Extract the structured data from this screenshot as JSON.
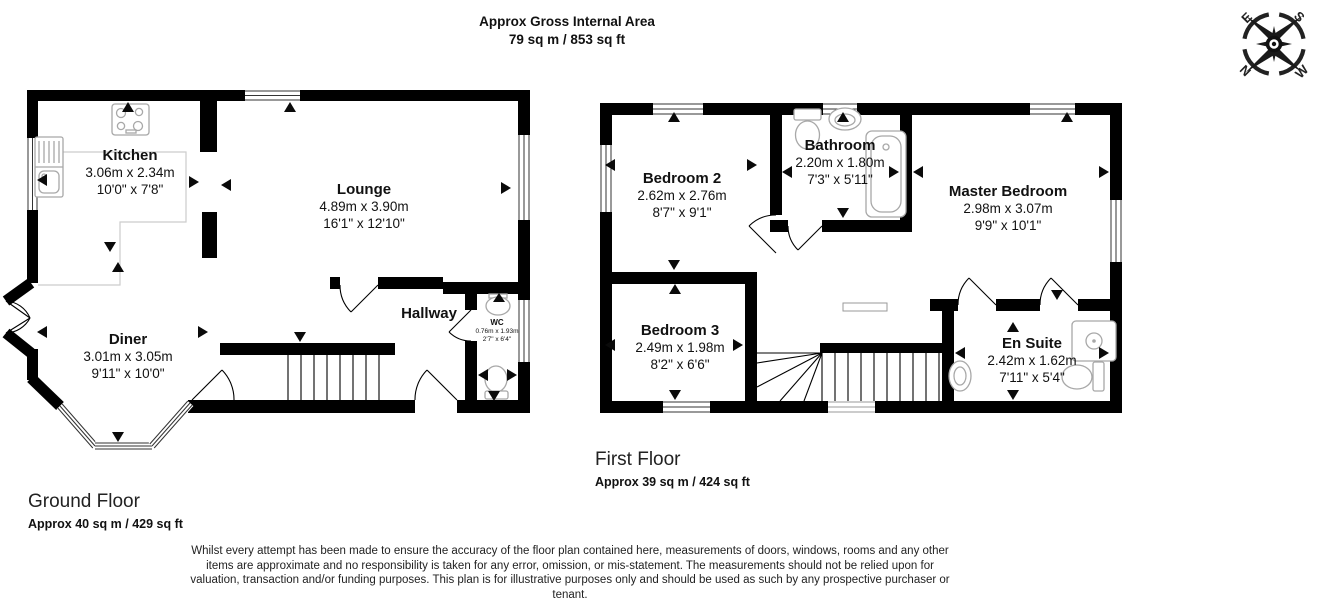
{
  "header": {
    "title": "Approx Gross Internal Area",
    "subtitle": "79 sq m / 853 sq ft"
  },
  "compass": {
    "north": "N",
    "east": "E",
    "south": "S",
    "west": "W"
  },
  "ground_floor": {
    "name": "Ground Floor",
    "area": "Approx 40 sq m / 429 sq ft",
    "rooms": {
      "kitchen": {
        "name": "Kitchen",
        "metric": "3.06m x 2.34m",
        "imperial": "10'0\" x 7'8\""
      },
      "lounge": {
        "name": "Lounge",
        "metric": "4.89m x 3.90m",
        "imperial": "16'1\" x 12'10\""
      },
      "diner": {
        "name": "Diner",
        "metric": "3.01m x 3.05m",
        "imperial": "9'11\" x 10'0\""
      },
      "hallway": {
        "name": "Hallway"
      },
      "wc": {
        "name": "WC",
        "metric": "0.76m x 1.93m",
        "imperial": "2'7\" x 6'4\""
      }
    }
  },
  "first_floor": {
    "name": "First Floor",
    "area": "Approx 39 sq m / 424 sq ft",
    "rooms": {
      "bedroom2": {
        "name": "Bedroom 2",
        "metric": "2.62m x 2.76m",
        "imperial": "8'7\" x 9'1\""
      },
      "bathroom": {
        "name": "Bathroom",
        "metric": "2.20m x 1.80m",
        "imperial": "7'3\" x 5'11\""
      },
      "master": {
        "name": "Master Bedroom",
        "metric": "2.98m x 3.07m",
        "imperial": "9'9\" x 10'1\""
      },
      "bedroom3": {
        "name": "Bedroom 3",
        "metric": "2.49m x 1.98m",
        "imperial": "8'2\" x 6'6\""
      },
      "ensuite": {
        "name": "En Suite",
        "metric": "2.42m x 1.62m",
        "imperial": "7'11\" x 5'4\""
      }
    }
  },
  "disclaimer": {
    "text": "Whilst every attempt has been made to ensure the accuracy of the floor plan contained here, measurements of doors, windows, rooms and any other items are approximate and no responsibility is taken for any error, omission, or mis-statement. The measurements should not be relied upon for valuation, transaction and/or funding purposes. This plan is for illustrative purposes only and should be used as such by any prospective purchaser or tenant."
  }
}
